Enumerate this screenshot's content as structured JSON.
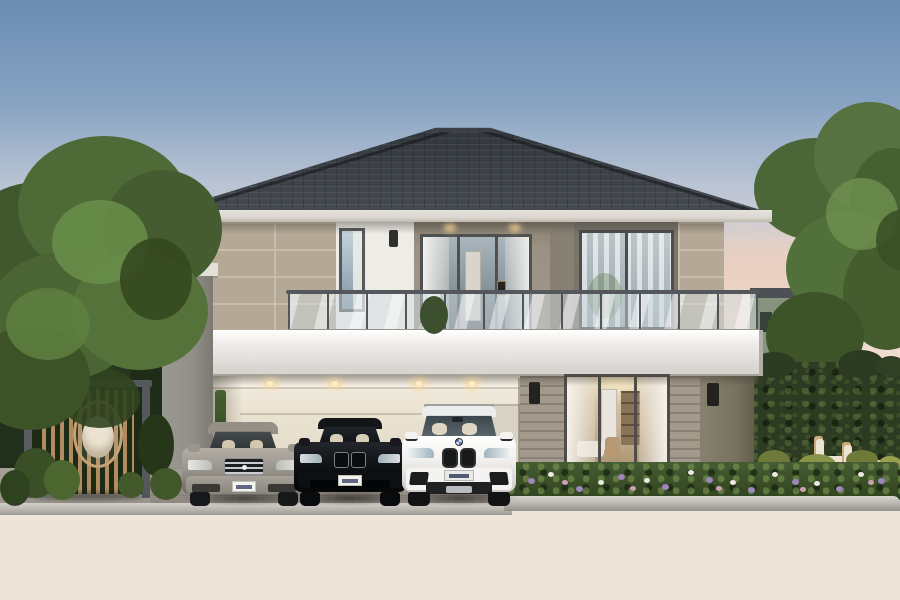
{
  "scene": {
    "description": "dusk architectural rendering of a modern two-storey house with balcony, carport with three cars, pergola with hanging egg chair, hedges and garden",
    "objects": [
      "hip-roof",
      "second-floor",
      "glass-balustrade",
      "balcony-slab-band",
      "carport",
      "sliding-glass-door",
      "pergola",
      "egg-chair",
      "left-tree",
      "right-tree",
      "hedge",
      "flower-bed",
      "road",
      "lounge-chairs"
    ],
    "cars": [
      {
        "name": "silver-sedan",
        "body_color": "#9a958d"
      },
      {
        "name": "black-sedan",
        "body_color": "#121418"
      },
      {
        "name": "white-suv",
        "body_color": "#f2f1ee"
      }
    ]
  },
  "palette": {
    "skyTop": "#6a8db3",
    "skyMid": "#bac4d4",
    "skyLow": "#e9dfd9",
    "roofA": "#31363c",
    "roofB": "#474c53",
    "fascia": "#dcd8d1",
    "tile": "#b4a896",
    "tileJoint": "#c8bdab",
    "whiteWall": "#eeece7",
    "recessWall": "#9a9183",
    "recessSide": "#877f72",
    "winWallR": "#7a756b",
    "bandA": "#f4f3f1",
    "bandB": "#d8d5d0",
    "pillar": "#928f89",
    "pillarDark": "#76705f",
    "siding": "#a39a8c",
    "carportA": "#f3eee3",
    "carportB": "#ded5c4",
    "frame": "#4e4d49",
    "glassA": "#9fb3c0",
    "glassB": "#8fa2ab",
    "curtain": "#eceae6",
    "interiorA": "#e2d2b4",
    "interiorB": "#a08a6b",
    "hedge": "#2c3b21",
    "paver": "#968f86",
    "curb": "#b9b6b0",
    "roadA": "#5a5d60",
    "roadB": "#42454a",
    "woodSlat": "#b08c60",
    "pergFrame": "#55585c",
    "chairWood": "#cba97c",
    "cushion": "#ece3d2"
  },
  "sprites": [
    {
      "n": "cloud",
      "x": 640,
      "y": 236,
      "w": 240,
      "h": 54,
      "c": "#f0cdb8",
      "o": 0.5,
      "b": 10,
      "z": 1
    },
    {
      "n": "cloud",
      "x": 40,
      "y": 252,
      "w": 190,
      "h": 44,
      "c": "#ecd3c4",
      "o": 0.4,
      "b": 10,
      "z": 1
    },
    {
      "n": "cloud",
      "x": 760,
      "y": 298,
      "w": 140,
      "h": 42,
      "c": "#f3d6c0",
      "o": 0.45,
      "b": 10,
      "z": 1
    },
    {
      "n": "left-bg-wall",
      "x": 0,
      "y": 344,
      "w": 58,
      "h": 48,
      "c": "#c3c6c4",
      "o": 0.9,
      "z": 5,
      "rad": "2px"
    },
    {
      "n": "left-backdrop-foliage",
      "x": -10,
      "y": 225,
      "w": 100,
      "h": 290,
      "c": "#22301b",
      "z": 6,
      "rad": "30%"
    },
    {
      "n": "left-backdrop-foliage",
      "x": 80,
      "y": 320,
      "w": 80,
      "h": 180,
      "c": "#273620",
      "z": 6,
      "rad": "30%"
    },
    {
      "n": "left-backdrop-foliage",
      "x": 128,
      "y": 356,
      "w": 44,
      "h": 140,
      "c": "#1f2c18",
      "z": 6,
      "rad": "30%"
    },
    {
      "n": "right-tree-trunk",
      "x": 845,
      "y": 296,
      "w": 9,
      "h": 170,
      "c": "#6b5740",
      "z": 7,
      "rad": "4px"
    },
    {
      "n": "right-tree-branch",
      "x": 856,
      "y": 238,
      "w": 6,
      "h": 70,
      "c": "#6b5740",
      "z": 7,
      "rad": "3px",
      "rot": -20
    },
    {
      "n": "right-tree-foliage",
      "x": 754,
      "y": 138,
      "w": 122,
      "h": 102,
      "c": "#4b6637",
      "z": 8
    },
    {
      "n": "right-tree-foliage",
      "x": 814,
      "y": 102,
      "w": 112,
      "h": 108,
      "c": "#567240",
      "z": 8
    },
    {
      "n": "right-tree-foliage",
      "x": 850,
      "y": 148,
      "w": 84,
      "h": 112,
      "c": "#476031",
      "z": 8
    },
    {
      "n": "right-tree-foliage",
      "x": 786,
      "y": 212,
      "w": 124,
      "h": 112,
      "c": "#527039",
      "z": 8
    },
    {
      "n": "right-tree-foliage",
      "x": 843,
      "y": 238,
      "w": 88,
      "h": 112,
      "c": "#445c2e",
      "z": 8
    },
    {
      "n": "right-tree-foliage",
      "x": 766,
      "y": 292,
      "w": 98,
      "h": 88,
      "c": "#3d5429",
      "z": 8
    },
    {
      "n": "right-tree-foliage",
      "x": 826,
      "y": 178,
      "w": 72,
      "h": 72,
      "c": "#6f9150",
      "o": 0.8,
      "z": 8
    },
    {
      "n": "right-tree-foliage",
      "x": 876,
      "y": 210,
      "w": 50,
      "h": 60,
      "c": "#3a5026",
      "o": 0.9,
      "z": 8
    },
    {
      "n": "hedge-bump",
      "x": 752,
      "y": 352,
      "w": 44,
      "h": 26,
      "c": "#2c3b21",
      "z": 10
    },
    {
      "n": "hedge-bump",
      "x": 792,
      "y": 356,
      "w": 52,
      "h": 24,
      "c": "#30402  4",
      "z": 10
    },
    {
      "n": "hedge-bump",
      "x": 838,
      "y": 350,
      "w": 46,
      "h": 28,
      "c": "#2c3b21",
      "z": 10
    },
    {
      "n": "hedge-bump",
      "x": 876,
      "y": 356,
      "w": 30,
      "h": 22,
      "c": "#304024",
      "z": 10
    },
    {
      "n": "balcony-downlight-glow",
      "x": 444,
      "y": 224,
      "w": 12,
      "h": 8,
      "c": "#ffd693",
      "o": 0.8,
      "b": 3,
      "z": 25
    },
    {
      "n": "balcony-downlight-glow",
      "x": 509,
      "y": 224,
      "w": 12,
      "h": 8,
      "c": "#ffd693",
      "o": 0.8,
      "b": 3,
      "z": 25
    },
    {
      "n": "carport-downlight-glow",
      "x": 262,
      "y": 379,
      "w": 16,
      "h": 10,
      "c": "#ffd693",
      "o": 0.85,
      "b": 4,
      "z": 25
    },
    {
      "n": "carport-downlight-glow",
      "x": 327,
      "y": 379,
      "w": 16,
      "h": 10,
      "c": "#ffd693",
      "o": 0.85,
      "b": 4,
      "z": 25
    },
    {
      "n": "carport-downlight-glow",
      "x": 411,
      "y": 379,
      "w": 16,
      "h": 10,
      "c": "#ffd693",
      "o": 0.85,
      "b": 4,
      "z": 25
    },
    {
      "n": "carport-downlight-glow",
      "x": 464,
      "y": 379,
      "w": 16,
      "h": 10,
      "c": "#ffd693",
      "o": 0.85,
      "b": 4,
      "z": 25
    },
    {
      "n": "carport-downlight-core",
      "x": 267,
      "y": 381,
      "w": 6,
      "h": 5,
      "c": "#ffeec8",
      "z": 26
    },
    {
      "n": "carport-downlight-core",
      "x": 332,
      "y": 381,
      "w": 6,
      "h": 5,
      "c": "#ffeec8",
      "z": 26
    },
    {
      "n": "carport-downlight-core",
      "x": 416,
      "y": 381,
      "w": 6,
      "h": 5,
      "c": "#ffeec8",
      "z": 26
    },
    {
      "n": "carport-downlight-core",
      "x": 469,
      "y": 381,
      "w": 6,
      "h": 5,
      "c": "#ffeec8",
      "z": 26
    },
    {
      "n": "shrub",
      "x": 758,
      "y": 450,
      "w": 32,
      "h": 22,
      "c": "#6d7a3a",
      "z": 32
    },
    {
      "n": "shrub",
      "x": 798,
      "y": 454,
      "w": 38,
      "h": 22,
      "c": "#8a9448",
      "z": 32
    },
    {
      "n": "shrub",
      "x": 846,
      "y": 450,
      "w": 32,
      "h": 20,
      "c": "#6e7a38",
      "z": 32
    },
    {
      "n": "shrub",
      "x": 878,
      "y": 456,
      "w": 24,
      "h": 18,
      "c": "#99a14f",
      "z": 32
    },
    {
      "n": "flower",
      "x": 528,
      "y": 478,
      "w": 7,
      "h": 6,
      "c": "#9f86bd",
      "z": 35
    },
    {
      "n": "flower",
      "x": 548,
      "y": 472,
      "w": 6,
      "h": 5,
      "c": "#eceae4",
      "z": 35
    },
    {
      "n": "flower",
      "x": 562,
      "y": 480,
      "w": 6,
      "h": 5,
      "c": "#cf9fb4",
      "z": 35
    },
    {
      "n": "flower",
      "x": 576,
      "y": 486,
      "w": 7,
      "h": 6,
      "c": "#9f86bd",
      "z": 35
    },
    {
      "n": "flower",
      "x": 598,
      "y": 480,
      "w": 6,
      "h": 5,
      "c": "#eceae4",
      "z": 35
    },
    {
      "n": "flower",
      "x": 618,
      "y": 474,
      "w": 7,
      "h": 6,
      "c": "#9f86bd",
      "z": 35
    },
    {
      "n": "flower",
      "x": 630,
      "y": 486,
      "w": 6,
      "h": 5,
      "c": "#cf9fb4",
      "z": 35
    },
    {
      "n": "flower",
      "x": 644,
      "y": 478,
      "w": 6,
      "h": 5,
      "c": "#eceae4",
      "z": 35
    },
    {
      "n": "flower",
      "x": 662,
      "y": 484,
      "w": 7,
      "h": 6,
      "c": "#9f86bd",
      "z": 35
    },
    {
      "n": "flower",
      "x": 688,
      "y": 470,
      "w": 6,
      "h": 5,
      "c": "#eceae4",
      "z": 35
    },
    {
      "n": "flower",
      "x": 706,
      "y": 477,
      "w": 7,
      "h": 6,
      "c": "#9f86bd",
      "z": 35
    },
    {
      "n": "flower",
      "x": 716,
      "y": 486,
      "w": 6,
      "h": 5,
      "c": "#cf9fb4",
      "z": 35
    },
    {
      "n": "flower",
      "x": 730,
      "y": 480,
      "w": 6,
      "h": 5,
      "c": "#eceae4",
      "z": 35
    },
    {
      "n": "flower",
      "x": 748,
      "y": 487,
      "w": 7,
      "h": 6,
      "c": "#9f86bd",
      "z": 35
    },
    {
      "n": "flower",
      "x": 772,
      "y": 472,
      "w": 6,
      "h": 5,
      "c": "#eceae4",
      "z": 35
    },
    {
      "n": "flower",
      "x": 792,
      "y": 479,
      "w": 7,
      "h": 6,
      "c": "#9f86bd",
      "z": 35
    },
    {
      "n": "flower",
      "x": 800,
      "y": 487,
      "w": 6,
      "h": 5,
      "c": "#cf9fb4",
      "z": 35
    },
    {
      "n": "flower",
      "x": 814,
      "y": 481,
      "w": 6,
      "h": 5,
      "c": "#eceae4",
      "z": 35
    },
    {
      "n": "flower",
      "x": 836,
      "y": 486,
      "w": 7,
      "h": 6,
      "c": "#9f86bd",
      "z": 35
    },
    {
      "n": "flower",
      "x": 858,
      "y": 472,
      "w": 6,
      "h": 5,
      "c": "#eceae4",
      "z": 35
    },
    {
      "n": "flower",
      "x": 868,
      "y": 480,
      "w": 6,
      "h": 5,
      "c": "#cf9fb4",
      "z": 35
    },
    {
      "n": "flower",
      "x": 878,
      "y": 478,
      "w": 7,
      "h": 6,
      "c": "#9f86bd",
      "z": 35
    },
    {
      "n": "left-tree-trunk",
      "x": 72,
      "y": 316,
      "w": 9,
      "h": 150,
      "c": "#5c4a36",
      "z": 39,
      "rad": "4px"
    },
    {
      "n": "left-tree-foliage",
      "x": -36,
      "y": 182,
      "w": 150,
      "h": 118,
      "c": "#41582e",
      "z": 42
    },
    {
      "n": "left-tree-foliage",
      "x": 18,
      "y": 136,
      "w": 172,
      "h": 142,
      "c": "#4d6a37",
      "z": 42
    },
    {
      "n": "left-tree-foliage",
      "x": 104,
      "y": 170,
      "w": 118,
      "h": 118,
      "c": "#445c30",
      "z": 42
    },
    {
      "n": "left-tree-foliage",
      "x": -12,
      "y": 252,
      "w": 152,
      "h": 128,
      "c": "#4a6433",
      "z": 42
    },
    {
      "n": "left-tree-foliage",
      "x": 72,
      "y": 252,
      "w": 136,
      "h": 118,
      "c": "#547239",
      "z": 42
    },
    {
      "n": "left-tree-foliage",
      "x": -28,
      "y": 326,
      "w": 118,
      "h": 104,
      "c": "#3c5328",
      "z": 42
    },
    {
      "n": "left-tree-foliage",
      "x": 52,
      "y": 200,
      "w": 96,
      "h": 84,
      "c": "#6a8e4a",
      "o": 0.85,
      "z": 42
    },
    {
      "n": "left-tree-foliage",
      "x": 6,
      "y": 288,
      "w": 84,
      "h": 72,
      "c": "#5e8041",
      "o": 0.85,
      "z": 42
    },
    {
      "n": "left-tree-foliage",
      "x": 120,
      "y": 238,
      "w": 72,
      "h": 82,
      "c": "#35481f",
      "o": 0.9,
      "z": 42
    },
    {
      "n": "left-tree-foliage",
      "x": 60,
      "y": 368,
      "w": 80,
      "h": 60,
      "c": "#31441f",
      "o": 0.9,
      "z": 41
    },
    {
      "n": "bush",
      "x": 138,
      "y": 414,
      "w": 36,
      "h": 62,
      "c": "#263619",
      "z": 44
    },
    {
      "n": "grass-tuft",
      "x": 14,
      "y": 448,
      "w": 44,
      "h": 50,
      "c": "#3a4f26",
      "z": 44
    },
    {
      "n": "grass-tuft",
      "x": 44,
      "y": 460,
      "w": 36,
      "h": 40,
      "c": "#4b662e",
      "z": 44
    },
    {
      "n": "grass-tuft",
      "x": 0,
      "y": 470,
      "w": 30,
      "h": 36,
      "c": "#2f4220",
      "z": 44
    },
    {
      "n": "grass-tuft",
      "x": 150,
      "y": 468,
      "w": 32,
      "h": 32,
      "c": "#415729",
      "z": 44
    },
    {
      "n": "grass-tuft",
      "x": 200,
      "y": 470,
      "w": 20,
      "h": 24,
      "c": "#3a4f26",
      "z": 44
    },
    {
      "n": "grass-tuft",
      "x": 118,
      "y": 472,
      "w": 26,
      "h": 26,
      "c": "#44592b",
      "z": 44
    },
    {
      "n": "balcony-plant",
      "x": 420,
      "y": 296,
      "w": 28,
      "h": 38,
      "c": "#3c5030",
      "z": 21
    }
  ]
}
